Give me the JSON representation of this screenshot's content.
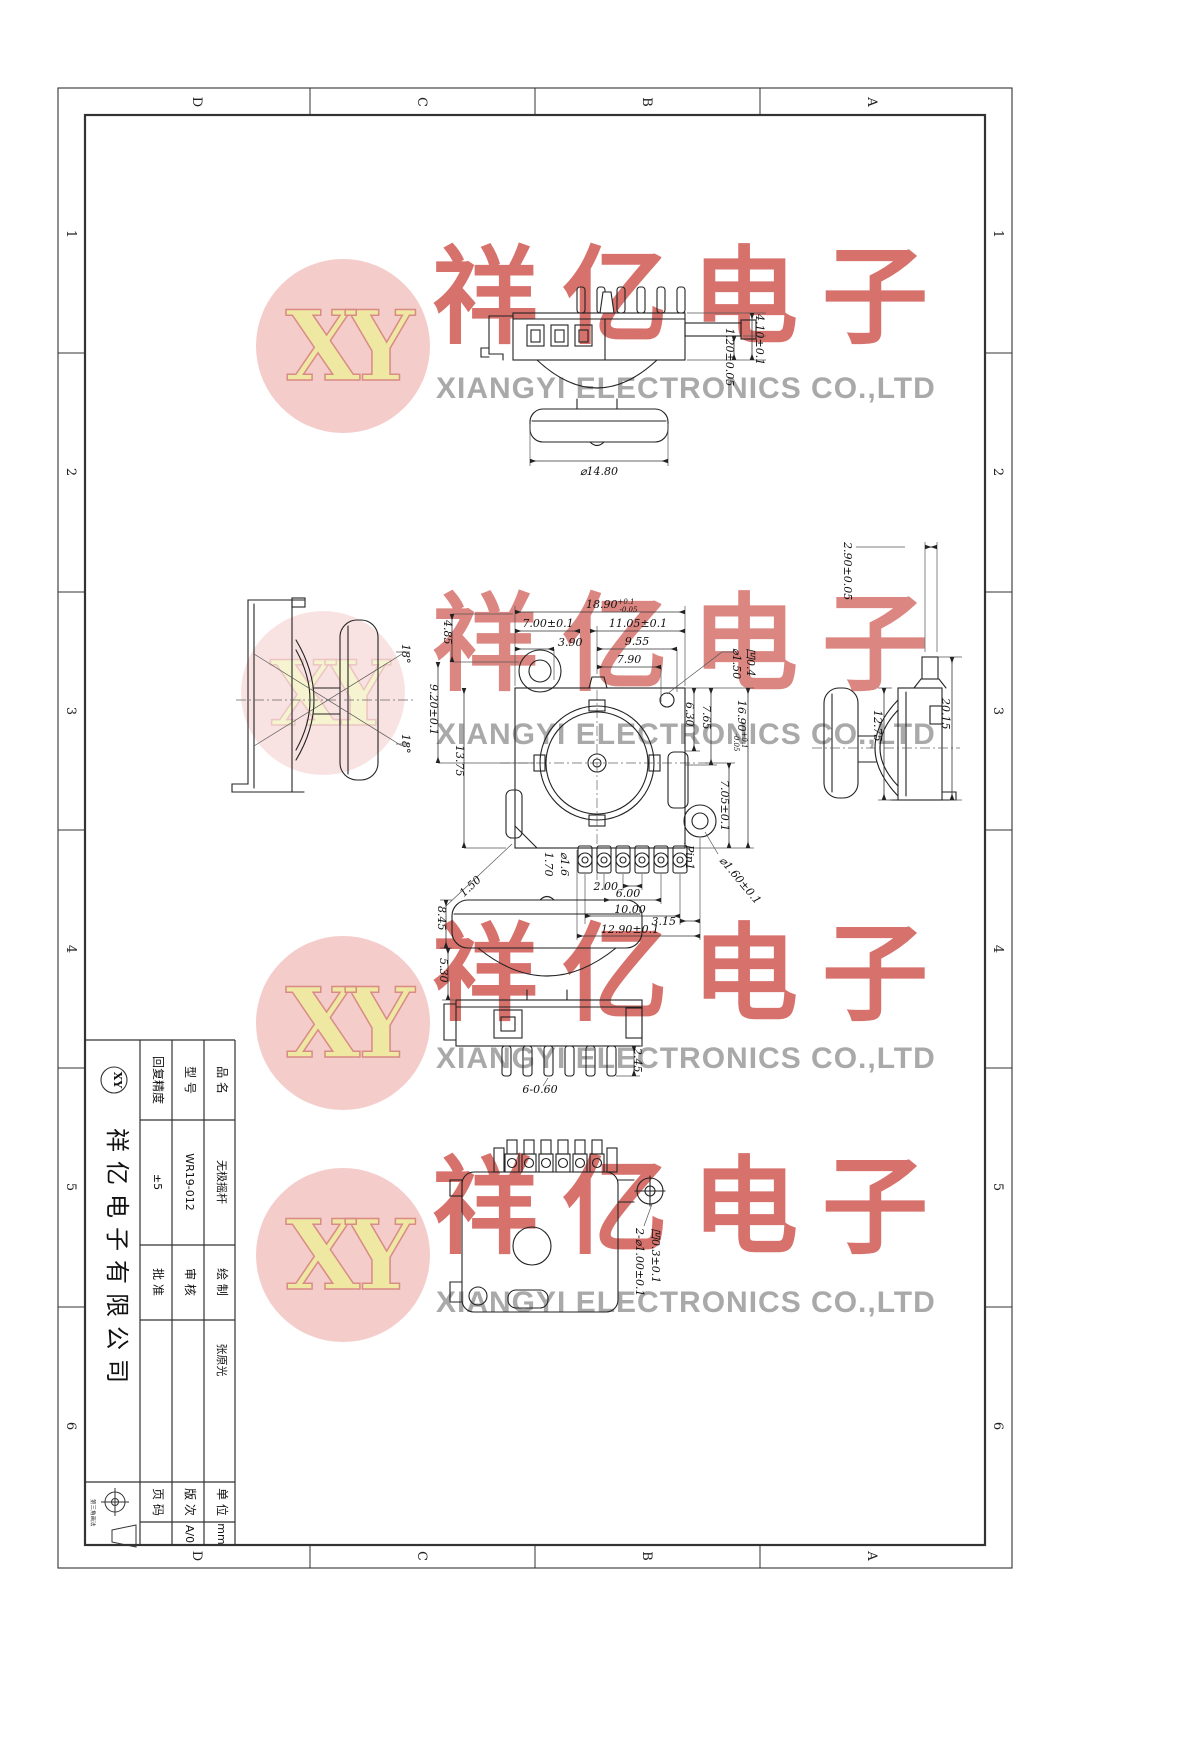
{
  "zones": {
    "letters": [
      "D",
      "C",
      "B",
      "A"
    ],
    "numbers": [
      "1",
      "2",
      "3",
      "4",
      "5",
      "6"
    ]
  },
  "watermark": {
    "logo": "XY",
    "cn": "祥亿电子",
    "en": "XIANGYI ELECTRONICS CO.,LTD",
    "red": "#c6342e",
    "pink": "#f3c8c6",
    "yellow": "#efe8a2",
    "gray": "#949494"
  },
  "views": {
    "side": {
      "h1": "4.10±0.1",
      "h2": "1.20±0.05",
      "dia": "⌀14.80"
    },
    "front": {
      "w": "18.90",
      "w_tp": "+0.1",
      "w_tm": "-0.05",
      "d700": "7.00±0.1",
      "d390": "3.90",
      "d1105": "11.05±0.1",
      "d955": "9.55",
      "d790": "7.90",
      "rec1": "⌀1.50",
      "rec2": "凹0.4",
      "d485": "4.85",
      "d920": "9.20±0.1",
      "d1375": "13.75",
      "d630": "6.30",
      "d765": "7.65",
      "h": "16.90",
      "h_tp": "+0.1",
      "h_tm": "-0.05",
      "d705": "7.05±0.1",
      "p200": "2.00",
      "p600": "6.00",
      "p1000": "10.00",
      "p1290": "12.90±0.1",
      "d315": "3.15",
      "c150": "1.50",
      "c170": "1.70",
      "c16": "⌀1.6",
      "pin1": "Pin1",
      "ear": "⌀1.60±0.1"
    },
    "left": {
      "a1": "18°",
      "a2": "18°"
    },
    "right": {
      "d290": "2.90±0.05",
      "d2015": "20.15",
      "d1275": "12.75"
    },
    "bottom": {
      "d845": "8.45",
      "d530": "5.30",
      "d245": "2.45",
      "d660": "6-0.60"
    },
    "back": {
      "c1": "2-⌀1.00±0.1",
      "c2": "凹0.3±0.1"
    }
  },
  "title_block": {
    "product_label": "品 名",
    "product": "无极摇杆",
    "model_label": "型 号",
    "model": "WR19-012",
    "precision_label": "回复精度",
    "precision": "±5",
    "draw_label": "绘 制",
    "drawn_by": "张原光",
    "check_label": "审 核",
    "approve_label": "批 准",
    "unit_label": "单 位",
    "unit": "mm",
    "rev_label": "版 次",
    "rev": "A/0",
    "page_label": "页 码",
    "company": "祥亿电子有限公司",
    "logo": "XY",
    "note": "第三角画法"
  }
}
